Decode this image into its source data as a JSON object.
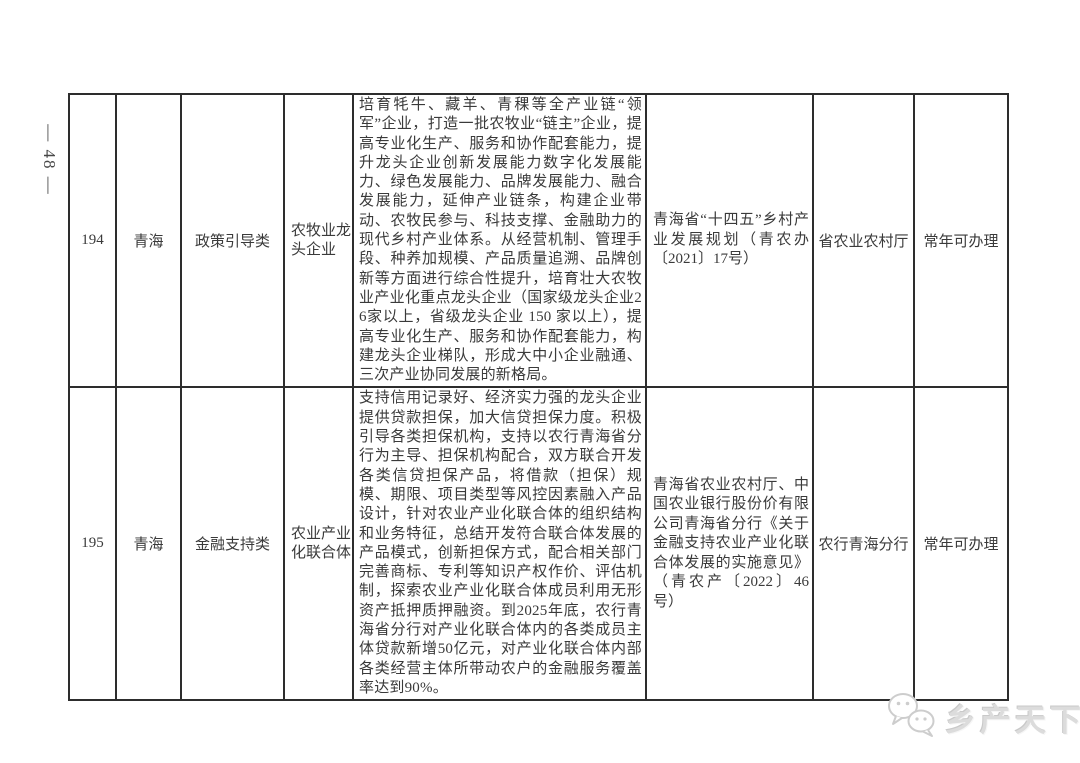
{
  "page": {
    "number_label": "— 48 —"
  },
  "watermark": {
    "icon": "wechat-bubbles-icon",
    "text": "乡产天下",
    "color": "#d6d6d6"
  },
  "table": {
    "border_color": "#2d2d2d",
    "rows": [
      {
        "id": "194",
        "province": "青海",
        "category": "政策引导类",
        "subject": "农牧业龙头企业",
        "description": "培育牦牛、藏羊、青稞等全产业链“领军”企业，打造一批农牧业“链主”企业，提高专业化生产、服务和协作配套能力，提升龙头企业创新发展能力数字化发展能力、绿色发展能力、品牌发展能力、融合发展能力，延伸产业链条，构建企业带动、农牧民参与、科技支撑、金融助力的现代乡村产业体系。从经营机制、管理手段、种养加规模、产品质量追溯、品牌创新等方面进行综合性提升，培育壮大农牧业产业化重点龙头企业（国家级龙头企业26家以上，省级龙头企业 150 家以上），提高专业化生产、服务和协作配套能力，构建龙头企业梯队，形成大中小企业融通、三次产业协同发展的新格局。",
        "policy_basis": "青海省“十四五”乡村产业发展规划（青农办〔2021〕17号）",
        "department": "省农业农村厅",
        "availability": "常年可办理"
      },
      {
        "id": "195",
        "province": "青海",
        "category": "金融支持类",
        "subject": "农业产业化联合体",
        "description": "支持信用记录好、经济实力强的龙头企业提供贷款担保，加大信贷担保力度。积极引导各类担保机构，支持以农行青海省分行为主导、担保机构配合，双方联合开发各类信贷担保产品，将借款（担保）规模、期限、项目类型等风控因素融入产品设计，针对农业产业化联合体的组织结构和业务特征，总结开发符合联合体发展的产品模式，创新担保方式，配合相关部门完善商标、专利等知识产权作价、评估机制，探索农业产业化联合体成员利用无形资产抵押质押融资。到2025年底，农行青海省分行对产业化联合体内的各类成员主体贷款新增50亿元，对产业化联合体内部各类经营主体所带动农户的金融服务覆盖率达到90%。",
        "policy_basis": "青海省农业农村厅、中国农业银行股份价有限公司青海省分行《关于金融支持农业产业化联合体发展的实施意见》（青农产〔2022〕46号）",
        "department": "农行青海分行",
        "availability": "常年可办理"
      }
    ]
  }
}
